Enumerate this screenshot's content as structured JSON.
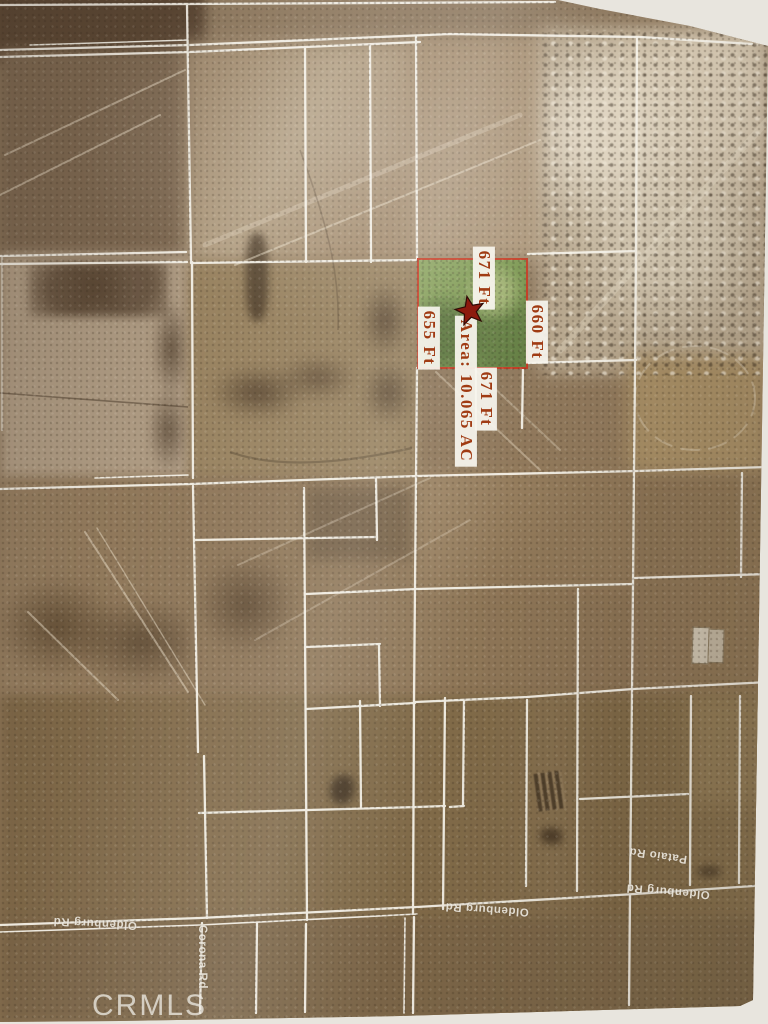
{
  "map": {
    "type": "aerial-parcel-map",
    "watermark": "CRMLS",
    "highlighted_parcel": {
      "area_label": "Area: 10.065 AC",
      "dim_top": "671 Ft",
      "dim_left": "655 Ft",
      "dim_right": "660 Ft",
      "dim_bottom": "671 Ft",
      "marker": "red-star",
      "fill_color": "#7b9750",
      "border_color": "#c23a21",
      "label_text_color": "#a03b13"
    },
    "road_labels": [
      {
        "id": "oldenburg-west",
        "text": "Oldenburg Rd"
      },
      {
        "id": "oldenburg-mid",
        "text": "Oldenburg Rd"
      },
      {
        "id": "oldenburg-east",
        "text": "Oldenburg Rd"
      },
      {
        "id": "pataio",
        "text": "Pataio Rd"
      },
      {
        "id": "corona",
        "text": "Corona Rd"
      }
    ],
    "colors": {
      "parcel_line": "#f6f3ea",
      "terrain_light": "#cfc3ae",
      "terrain_mid": "#91795c",
      "terrain_dark": "#5c4733",
      "page_background": "#e8e5de"
    }
  }
}
